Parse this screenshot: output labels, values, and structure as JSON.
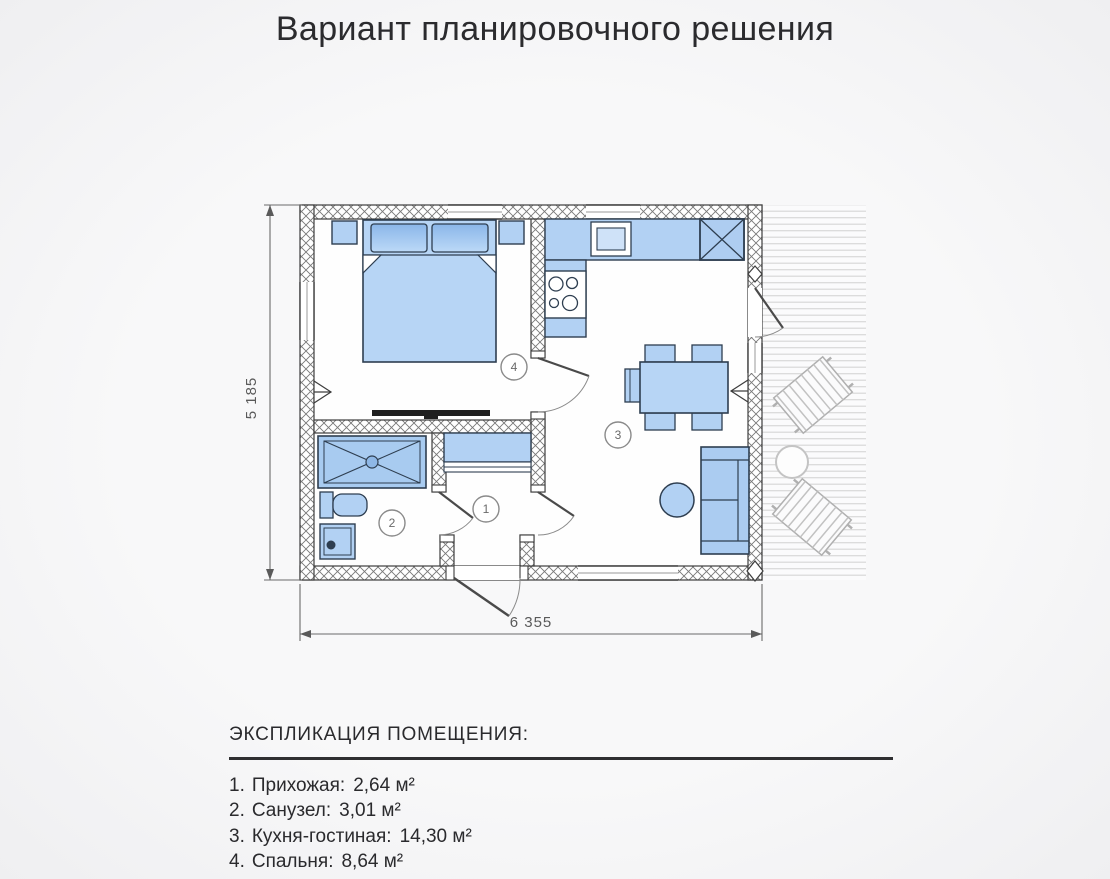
{
  "title": "Вариант планировочного решения",
  "plan": {
    "dim_height": "5 185",
    "dim_width": "6 355",
    "rooms": [
      {
        "number": "1",
        "list_prefix": "1.",
        "label": "Прихожая:",
        "area": "2,64 м²"
      },
      {
        "number": "2",
        "list_prefix": "2.",
        "label": "Санузел:",
        "area": "3,01 м²"
      },
      {
        "number": "3",
        "list_prefix": "3.",
        "label": "Кухня-гостиная:",
        "area": "14,30 м²"
      },
      {
        "number": "4",
        "list_prefix": "4.",
        "label": "Спальня:",
        "area": "8,64 м²"
      }
    ]
  },
  "legend": {
    "heading": "ЭКСПЛИКАЦИЯ ПОМЕЩЕНИЯ:"
  },
  "colors": {
    "furniture_fill": "#b2d1f3",
    "furniture_stroke": "#2e3e50",
    "wall_line": "#3d3d3d",
    "hatch": "#787878",
    "deck_line": "#d8d8d8",
    "dimension": "#5a5a5a",
    "text": "#2a2a2d"
  }
}
